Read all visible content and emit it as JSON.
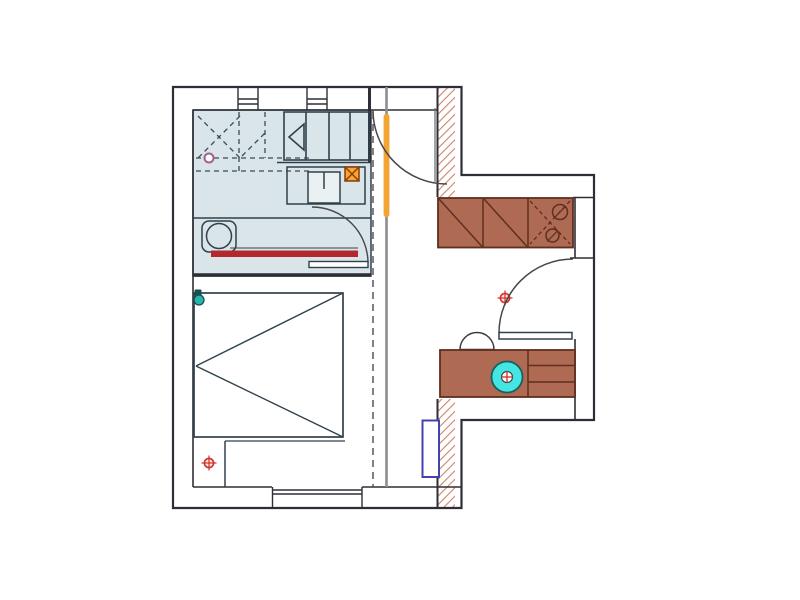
{
  "document": {
    "type": "architectural-floor-plan",
    "description": "Floor plan of a small apartment: bathroom with shower and washbasin top-left, bedroom with double bed below it, entry corridor with sliding-door track in the middle, kitchen wing on the right with counters, sink unit and hob",
    "visible_text": []
  },
  "canvas": {
    "width": 800,
    "height": 600,
    "background": "#ffffff"
  },
  "colors": {
    "wall": "#2e2e36",
    "fixtureLine": "#31414b",
    "doorArc": "#46464e",
    "grayPartition": "#8d8d92",
    "dashLine": "#4a4a52",
    "showerLine": "#3c4b55",
    "floorBath": "#d9e5e9",
    "washerFill": "#e9f1f3",
    "counterFill": "#ae6a53",
    "counterLine": "#5f2f1f",
    "hatchStripe": "#cd8468",
    "redBar": "#b3282a",
    "orangeHighlight": "#f3a432",
    "orangeBoxFill": "#f5a82c",
    "orangeBoxLine": "#8a3a10",
    "cyanFill": "#43e6e2",
    "cyanLine": "#17605d",
    "radiatorBlue": "#4343b0",
    "lampTeal": "#27b5ab",
    "lampDark": "#174f52",
    "drainPink": "#a85c92",
    "markerRed": "#d23128",
    "markerFill": "#fceae8"
  },
  "elements": {
    "markers": [
      {
        "name": "position-marker-bedroom"
      },
      {
        "name": "position-marker-hall"
      }
    ],
    "doors": [
      {
        "name": "entry-door-swing"
      },
      {
        "name": "bathroom-door"
      },
      {
        "name": "kitchen-room-door"
      }
    ],
    "fixtures": [
      {
        "name": "shower-area"
      },
      {
        "name": "shower-drain"
      },
      {
        "name": "washbasin"
      },
      {
        "name": "towel-radiator"
      },
      {
        "name": "washing-machine"
      },
      {
        "name": "electrical-box"
      },
      {
        "name": "closet-shelves"
      },
      {
        "name": "double-bed"
      },
      {
        "name": "bed-lamp"
      },
      {
        "name": "kitchen-counter-top"
      },
      {
        "name": "kitchen-sink-unit"
      },
      {
        "name": "kitchen-counter-lower"
      },
      {
        "name": "hob-burner"
      },
      {
        "name": "counter-drawers"
      },
      {
        "name": "small-round-sink"
      },
      {
        "name": "radiator"
      },
      {
        "name": "sliding-door-track"
      },
      {
        "name": "glass-partition"
      }
    ],
    "windows": [
      {
        "name": "window-top-left"
      },
      {
        "name": "window-top-right"
      },
      {
        "name": "window-bottom"
      }
    ]
  }
}
